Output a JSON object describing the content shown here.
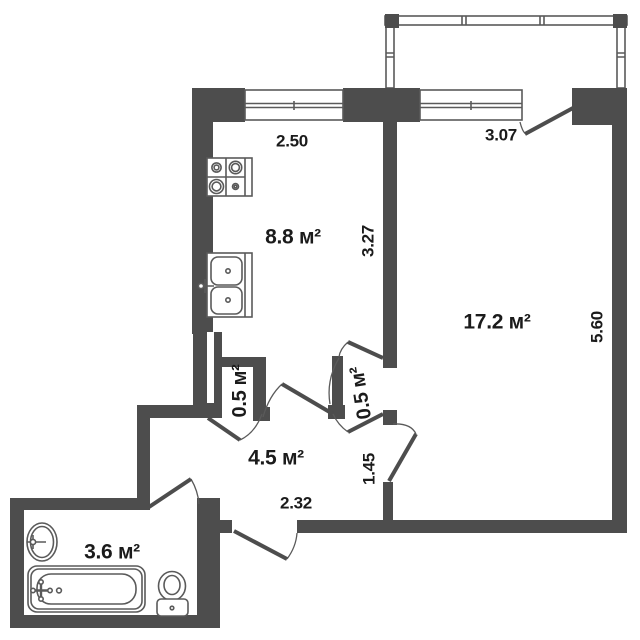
{
  "floor_plan": {
    "rooms": {
      "kitchen": "8.8 м²",
      "living_room": "17.2 м²",
      "hallway": "4.5 м²",
      "bathroom": "3.6 м²",
      "closet_left": "0.5 м²",
      "closet_right": "0.5 м²"
    },
    "dimensions": {
      "kitchen_window_width": "2.50",
      "living_window_width": "3.07",
      "kitchen_depth": "3.27",
      "living_depth": "5.60",
      "hallway_depth": "1.45",
      "hallway_width": "2.32"
    },
    "colors": {
      "wall": "#4d4d4d",
      "line": "#5a5a5a",
      "text": "#1b1b1b",
      "background": "#ffffff"
    }
  }
}
